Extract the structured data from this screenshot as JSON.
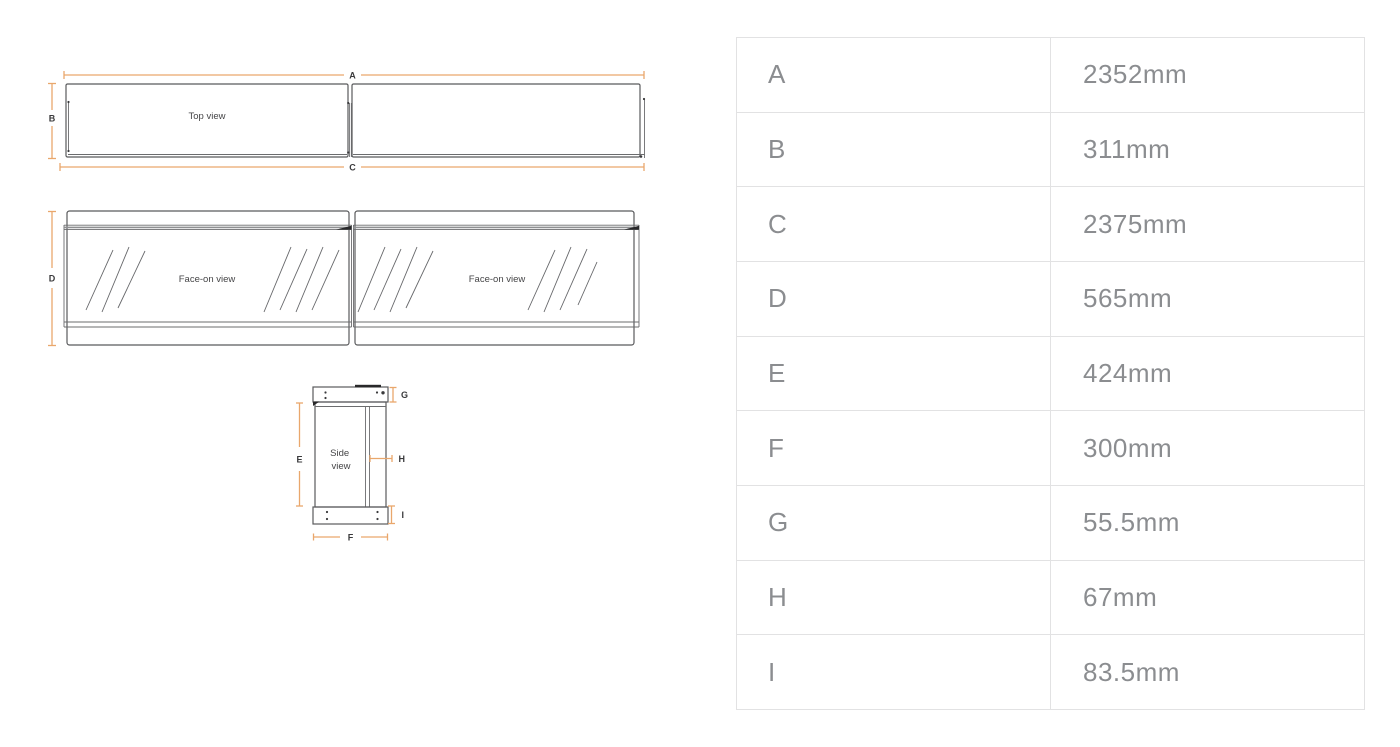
{
  "diagram": {
    "top_view": {
      "label": "Top view"
    },
    "face_on_left": {
      "label": "Face-on view"
    },
    "face_on_right": {
      "label": "Face-on view"
    },
    "side_view": {
      "label_lines": [
        "Side",
        "view"
      ]
    },
    "dim_labels": {
      "a": "A",
      "b": "B",
      "c": "C",
      "d": "D",
      "e": "E",
      "f": "F",
      "g": "G",
      "h": "H",
      "i": "I"
    }
  },
  "colors": {
    "dimension_accent": "#E9A76C",
    "drawing_outline": "#595A5C",
    "table_border": "#E2E2E3",
    "table_text": "#8B8D90"
  },
  "table": {
    "rows": [
      {
        "label": "A",
        "value": "2352mm"
      },
      {
        "label": "B",
        "value": "311mm"
      },
      {
        "label": "C",
        "value": "2375mm"
      },
      {
        "label": "D",
        "value": "565mm"
      },
      {
        "label": "E",
        "value": "424mm"
      },
      {
        "label": "F",
        "value": "300mm"
      },
      {
        "label": "G",
        "value": "55.5mm"
      },
      {
        "label": "H",
        "value": "67mm"
      },
      {
        "label": "I",
        "value": "83.5mm"
      }
    ]
  }
}
